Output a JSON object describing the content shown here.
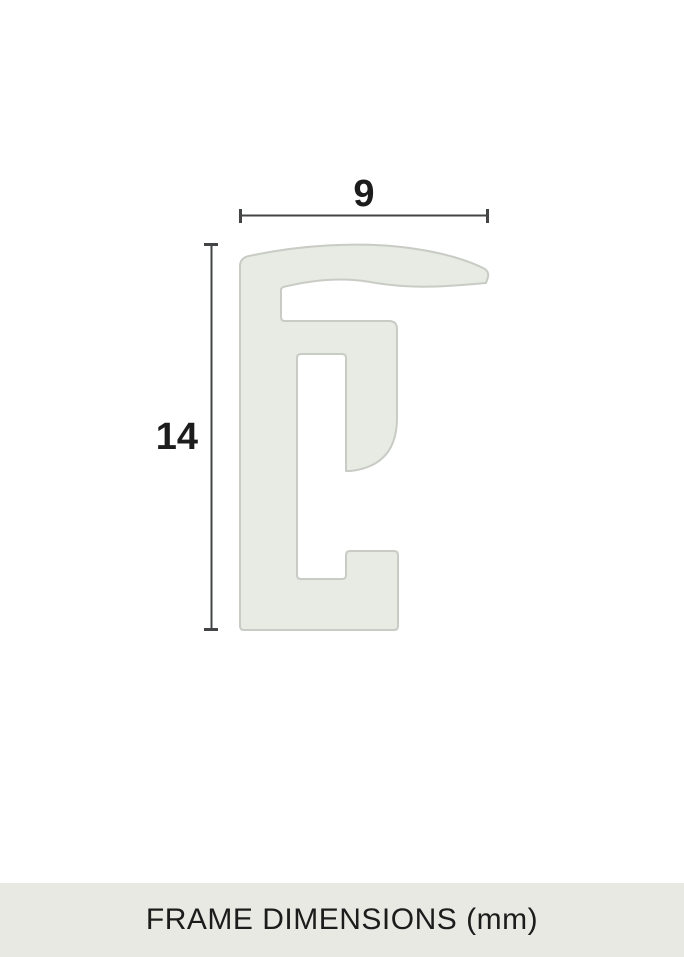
{
  "diagram": {
    "title": "frame moulding cross-section profile",
    "width_label": "9",
    "height_label": "14"
  },
  "caption": {
    "text": "FRAME DIMENSIONS (mm)"
  },
  "colors": {
    "background": "#ffffff",
    "profile_fill": "#e8eae4",
    "profile_stroke": "#c9cbc5",
    "dimension_line": "#434445",
    "label_text": "#1c1c1c",
    "caption_bg": "#e9e9e3",
    "caption_text": "#1c1c1c"
  }
}
